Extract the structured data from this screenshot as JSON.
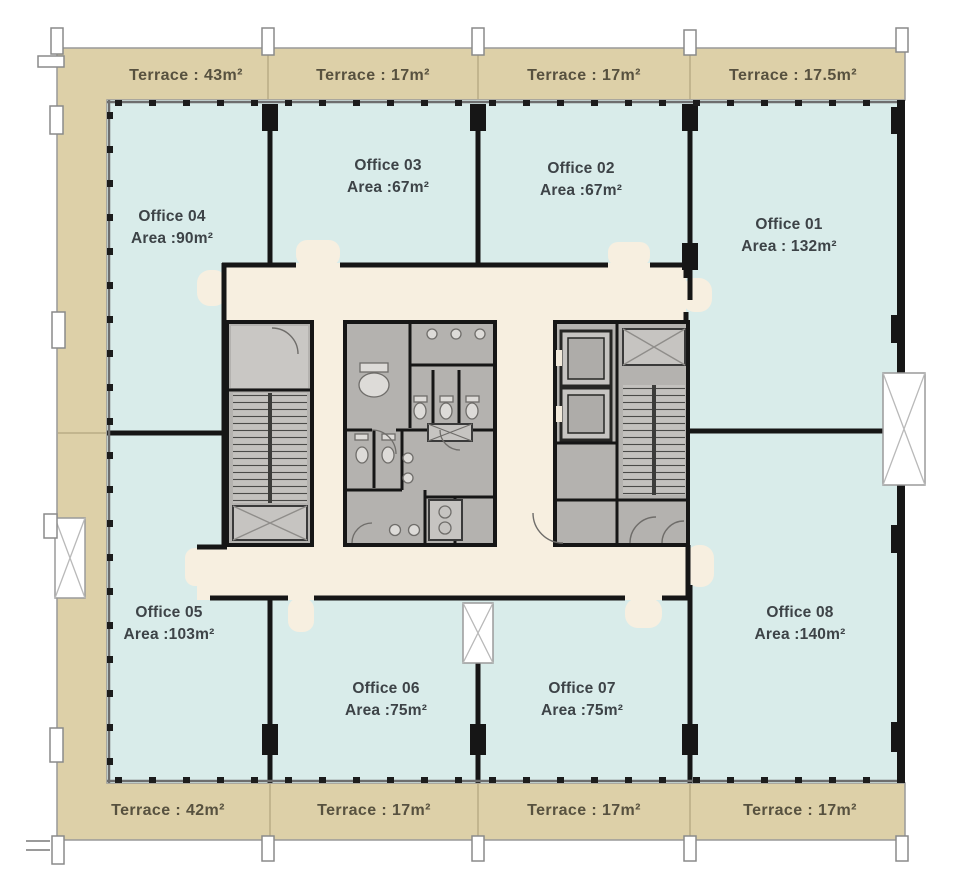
{
  "terraces": {
    "top": [
      "Terrace : 43m²",
      "Terrace : 17m²",
      "Terrace : 17m²",
      "Terrace : 17.5m²"
    ],
    "bottom": [
      "Terrace : 42m²",
      "Terrace : 17m²",
      "Terrace : 17m²",
      "Terrace : 17m²"
    ]
  },
  "offices": [
    {
      "name": "Office 01",
      "area": "Area : 132m²"
    },
    {
      "name": "Office 02",
      "area": "Area :67m²"
    },
    {
      "name": "Office 03",
      "area": "Area :67m²"
    },
    {
      "name": "Office 04",
      "area": "Area :90m²"
    },
    {
      "name": "Office 05",
      "area": "Area :103m²"
    },
    {
      "name": "Office 06",
      "area": "Area :75m²"
    },
    {
      "name": "Office 07",
      "area": "Area :75m²"
    },
    {
      "name": "Office 08",
      "area": "Area :140m²"
    }
  ],
  "core_features": [
    "stairwell-west",
    "restrooms",
    "elevator-bank",
    "stairwell-east",
    "service-shaft"
  ],
  "colors": {
    "terrace_fill": "#ddd0a8",
    "office_fill": "#d9ecea",
    "corridor_fill": "#f7efe0",
    "room_fill": "#b4b2af",
    "wall": "#161616",
    "terrace_text": "#57513f",
    "office_text": "#3d4347"
  }
}
